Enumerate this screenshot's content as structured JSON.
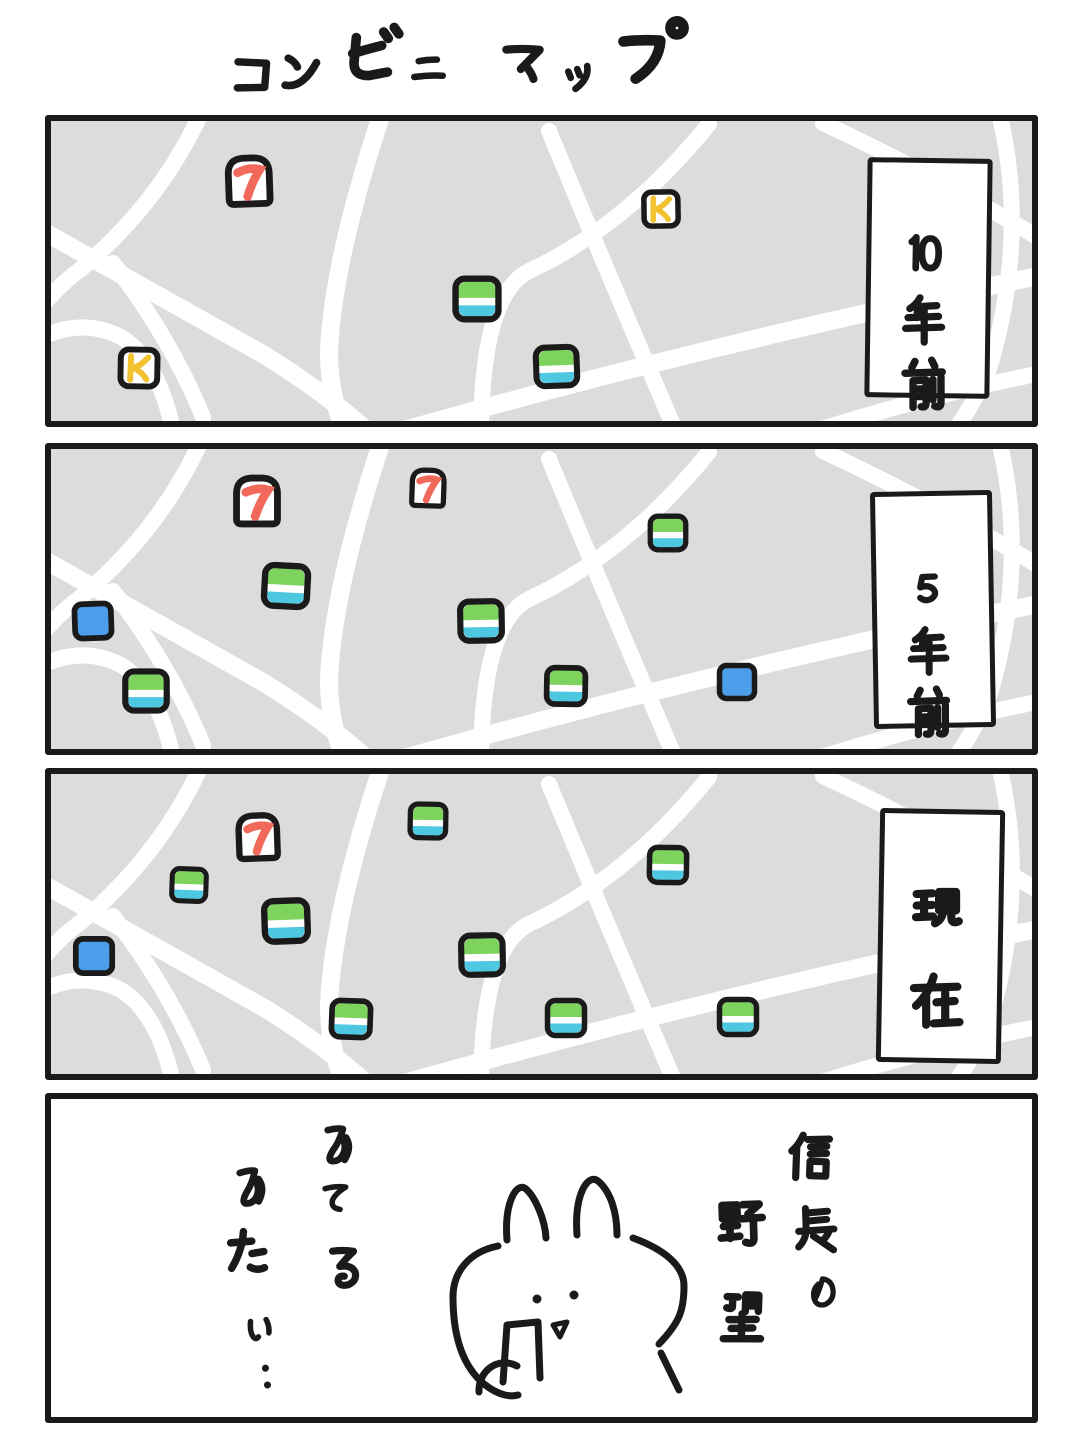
{
  "title": "コンビニマップ",
  "colors": {
    "ink": "#1a1a1a",
    "map_bg": "#dcdcda",
    "road": "#ffffff",
    "panel_bg": "#ffffff",
    "seven_red": "#f0695a",
    "k_yellow": "#f2c230",
    "fm_green": "#7ed35e",
    "fm_cyan": "#4ec7e0",
    "lawson_blue": "#4c9eeb"
  },
  "brands": {
    "seven": {
      "name": "seven-eleven",
      "glyph": "7"
    },
    "k": {
      "name": "circle-k",
      "glyph": "K"
    },
    "familymart": {
      "name": "familymart",
      "style": "green-white-cyan stripes"
    },
    "lawson": {
      "name": "lawson",
      "style": "solid blue"
    }
  },
  "panels": [
    {
      "name": "ten-years-ago",
      "label": "10年前",
      "markers": [
        {
          "brand": "seven",
          "x": 198,
          "y": 60,
          "s": 62,
          "r": -2
        },
        {
          "brand": "k",
          "x": 88,
          "y": 247,
          "s": 54,
          "r": 1
        },
        {
          "brand": "k",
          "x": 610,
          "y": 88,
          "s": 50,
          "r": -1
        },
        {
          "brand": "familymart",
          "x": 426,
          "y": 178,
          "s": 58,
          "r": 0
        },
        {
          "brand": "familymart",
          "x": 505,
          "y": 245,
          "s": 55,
          "r": -2
        }
      ]
    },
    {
      "name": "five-years-ago",
      "label": "5年前",
      "markers": [
        {
          "brand": "seven",
          "x": 206,
          "y": 52,
          "s": 62,
          "r": 0
        },
        {
          "brand": "seven",
          "x": 377,
          "y": 39,
          "s": 48,
          "r": 2
        },
        {
          "brand": "familymart",
          "x": 235,
          "y": 137,
          "s": 58,
          "r": 3
        },
        {
          "brand": "lawson",
          "x": 42,
          "y": 172,
          "s": 52,
          "r": -2
        },
        {
          "brand": "familymart",
          "x": 95,
          "y": 242,
          "s": 56,
          "r": 0
        },
        {
          "brand": "familymart",
          "x": 430,
          "y": 172,
          "s": 56,
          "r": -1
        },
        {
          "brand": "familymart",
          "x": 515,
          "y": 237,
          "s": 52,
          "r": 1
        },
        {
          "brand": "familymart",
          "x": 617,
          "y": 84,
          "s": 48,
          "r": 0
        },
        {
          "brand": "lawson",
          "x": 686,
          "y": 233,
          "s": 50,
          "r": 0
        }
      ]
    },
    {
      "name": "present",
      "label": "現在",
      "markers": [
        {
          "brand": "seven",
          "x": 207,
          "y": 63,
          "s": 58,
          "r": -2
        },
        {
          "brand": "familymart",
          "x": 138,
          "y": 111,
          "s": 46,
          "r": 2
        },
        {
          "brand": "familymart",
          "x": 235,
          "y": 147,
          "s": 58,
          "r": -2
        },
        {
          "brand": "familymart",
          "x": 377,
          "y": 47,
          "s": 48,
          "r": 1
        },
        {
          "brand": "lawson",
          "x": 43,
          "y": 182,
          "s": 52,
          "r": 0
        },
        {
          "brand": "familymart",
          "x": 300,
          "y": 245,
          "s": 52,
          "r": 2
        },
        {
          "brand": "familymart",
          "x": 431,
          "y": 181,
          "s": 56,
          "r": -1
        },
        {
          "brand": "familymart",
          "x": 515,
          "y": 244,
          "s": 50,
          "r": 0
        },
        {
          "brand": "familymart",
          "x": 617,
          "y": 91,
          "s": 50,
          "r": 1
        },
        {
          "brand": "familymart",
          "x": 687,
          "y": 243,
          "s": 50,
          "r": 0
        }
      ]
    }
  ],
  "final_panel": {
    "speech_left": [
      "みてる",
      "みたい…"
    ],
    "speech_right": [
      "信長の",
      "野望"
    ],
    "character": "rabbit-looking-at-phone"
  }
}
